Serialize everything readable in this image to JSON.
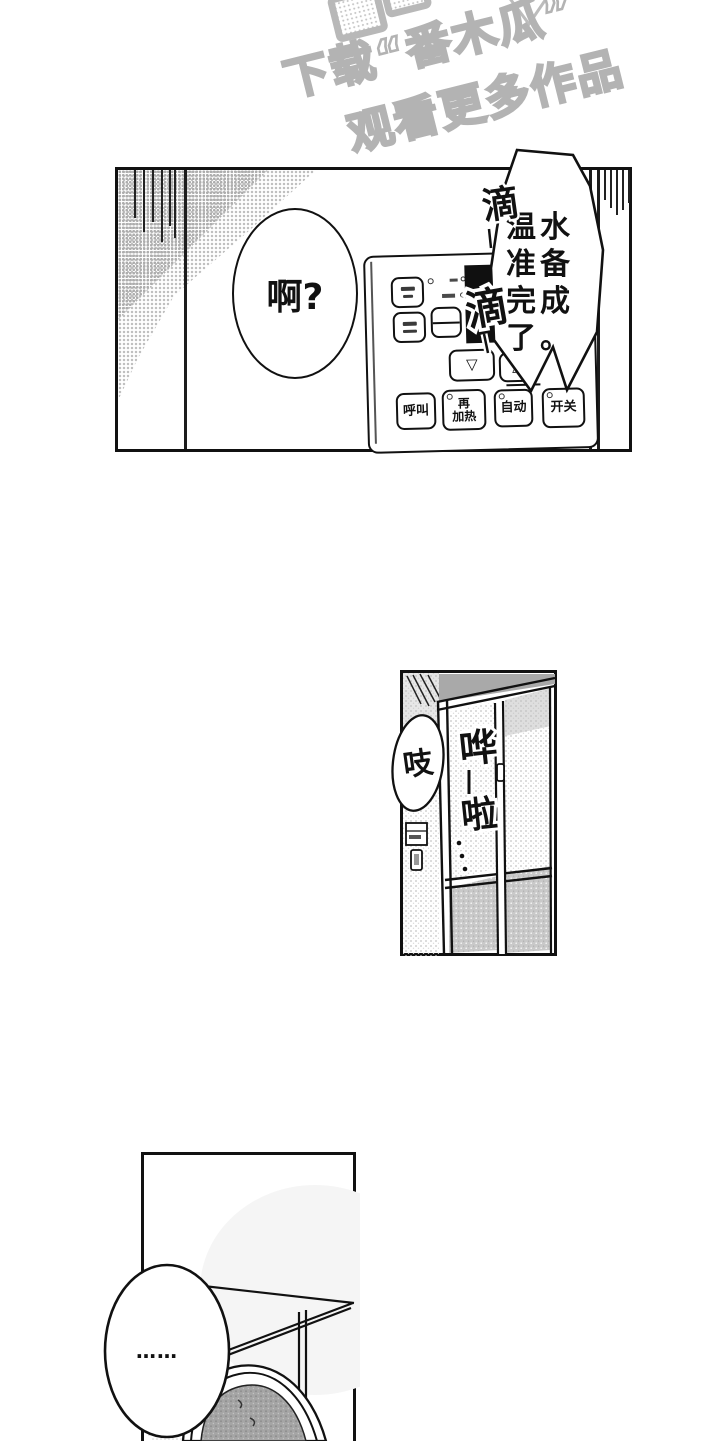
{
  "watermark": {
    "line1": "下载“番木瓜”",
    "line2": "观看更多作品"
  },
  "panel1": {
    "speech": "啊?",
    "machine_lines": [
      "温水",
      "准备",
      "完成",
      "了。"
    ],
    "sfx_drip_top": "滴",
    "sfx_drip_mid": "滴",
    "device": {
      "down": "▽",
      "up": "△",
      "call": "呼叫",
      "reheat_line1": "再",
      "reheat_line2": "加热",
      "auto": "自动",
      "power": "开关"
    }
  },
  "panel2": {
    "sfx_creak": "吱",
    "sfx_slide": {
      "char1": "哗",
      "dash": "ー",
      "char2": "啦",
      "dots": "…"
    }
  },
  "panel3": {
    "speech": "……"
  }
}
